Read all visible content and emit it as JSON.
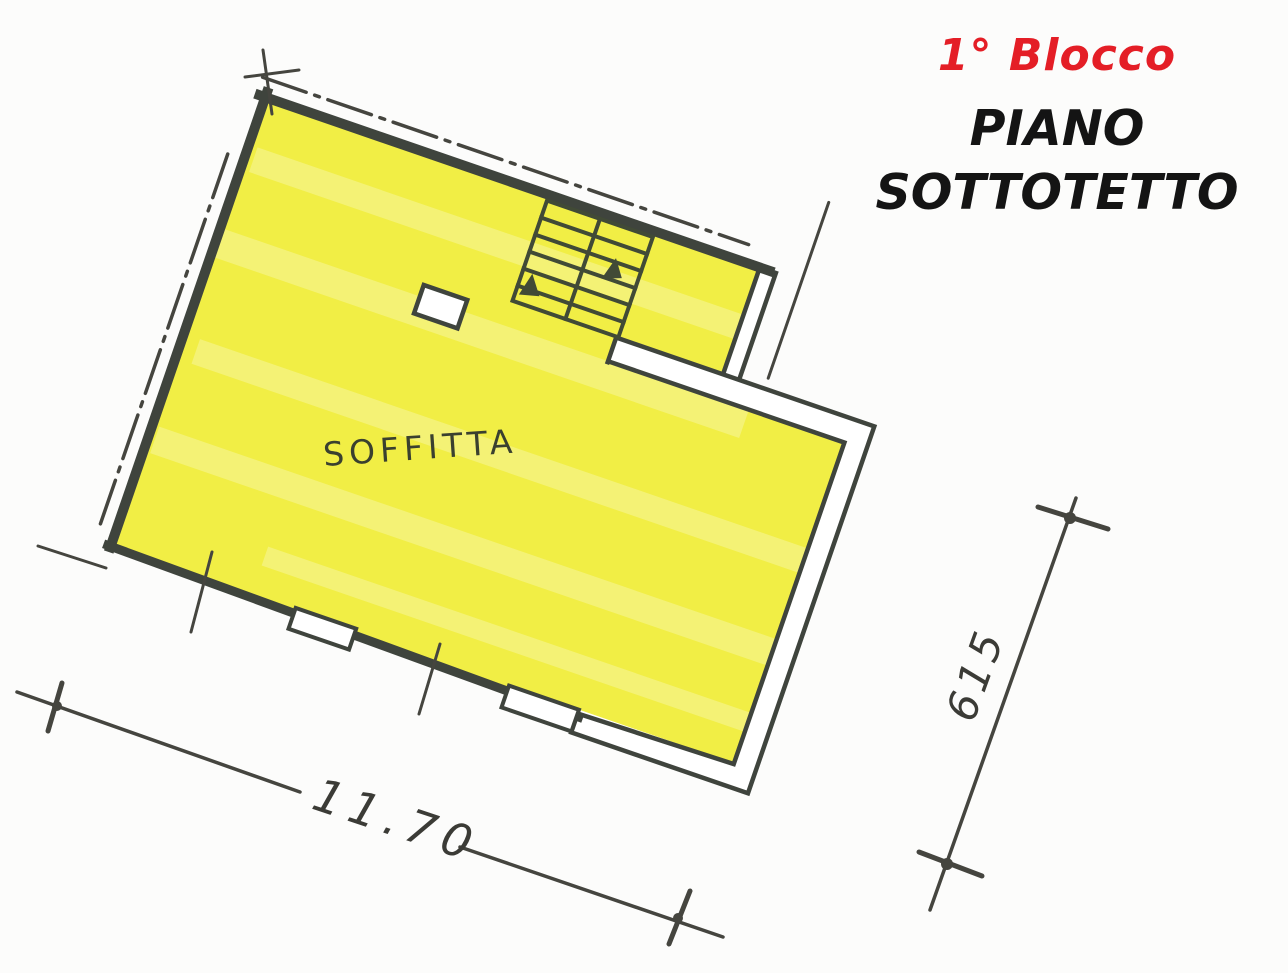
{
  "header": {
    "block_label": "1° Blocco",
    "floor_line1": "PIANO",
    "floor_line2": "SOTTOTETTO"
  },
  "plan": {
    "room_label": "SOFFITTA",
    "dim_bottom": "11.70",
    "dim_right": "615",
    "features": {
      "staircase": "double-flight-stair-with-direction-arrows",
      "chimney": "small-rect-opening",
      "windows": "two-openings-bottom-wall",
      "eaves": "dash-dot-roof-line-top-and-left"
    }
  },
  "colors": {
    "highlight": "#f1ee45",
    "wall": "#3f443d",
    "red": "#e41e26",
    "ink": "#141414",
    "annot": "#45453f",
    "hand": "#3a402f",
    "paper": "#fcfcfb"
  }
}
